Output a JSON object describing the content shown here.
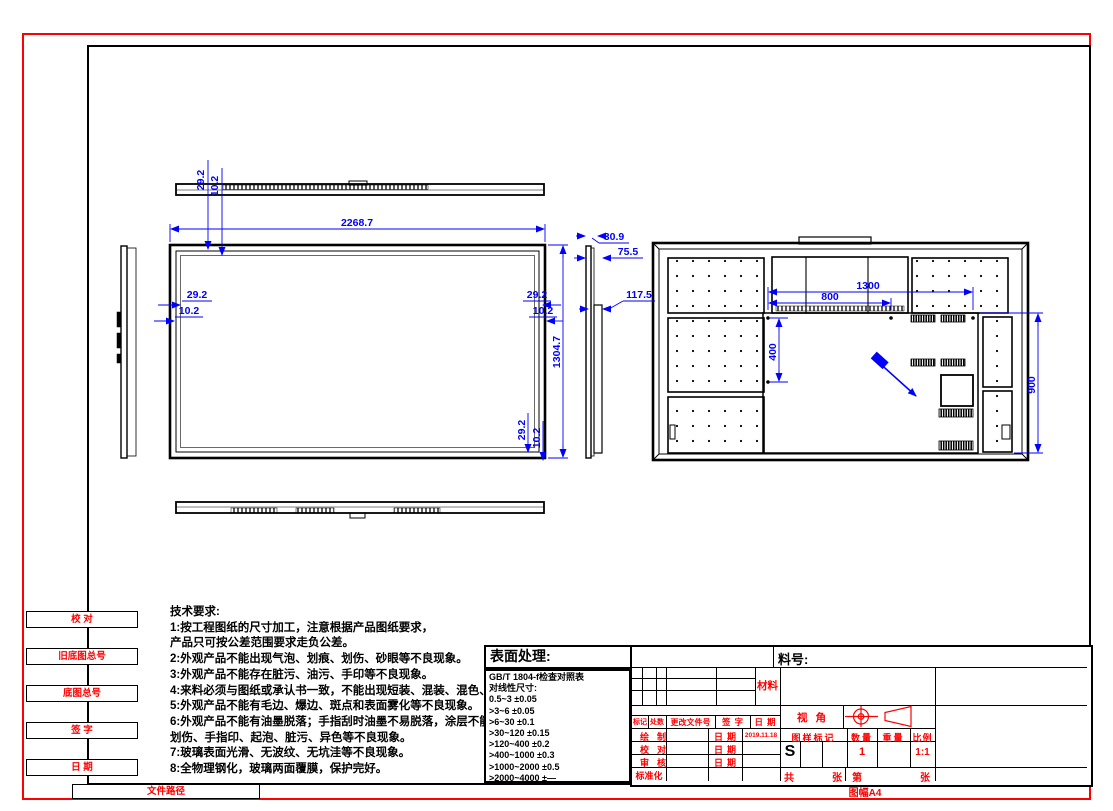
{
  "margin": {
    "labels": [
      "校  对",
      "旧底图总号",
      "底图总号",
      "签  字",
      "日  期",
      "文件路径"
    ]
  },
  "tech": {
    "title": "技术要求:",
    "lines": [
      "1:按工程图纸的尺寸加工，注意根据产品图纸要求，",
      "产品只可按公差范围要求走负公差。",
      "2:外观产品不能出现气泡、划痕、划伤、砂眼等不良现象。",
      "3:外观产品不能存在脏污、油污、手印等不良现象。",
      "4:来料必须与图纸或承认书一致，不能出现短装、混装、混色、异色等现象。",
      "5:外观产品不能有毛边、爆边、斑点和表面雾化等不良现象。",
      "6:外观产品不能有油墨脱落；手指刮时油墨不易脱落，涂层不能有划痕、",
      "划伤、手指印、起泡、脏污、异色等不良现象。",
      "7:玻璃表面光滑、无波纹、无坑洼等不良现象。",
      "8:全物理钢化，玻璃两面覆膜，保护完好。"
    ]
  },
  "surface": {
    "title": "表面处理:",
    "table": [
      "GB/T 1804-f检查对照表",
      "对线性尺寸:",
      "0.5~3  ±0.05",
      ">3~6  ±0.05",
      ">6~30  ±0.1",
      ">30~120  ±0.15",
      ">120~400  ±0.2",
      ">400~1000  ±0.3",
      ">1000~2000  ±0.5",
      ">2000~4000  ±—"
    ]
  },
  "title_block": {
    "part_no_label": "料号:",
    "material_label": "材料",
    "view_label": "视角",
    "rev_cols": [
      "标记",
      "处数",
      "更改文件号",
      "签字",
      "日期"
    ],
    "sign_rows": [
      {
        "label": "绘制",
        "date_label": "日期",
        "value": "2019.11.18"
      },
      {
        "label": "校对",
        "date_label": "日期",
        "value": ""
      },
      {
        "label": "审核",
        "date_label": "日期",
        "value": ""
      },
      {
        "label": "标准化",
        "date_label": "",
        "value": ""
      }
    ],
    "mark_cols": [
      "图样标记",
      "数量",
      "重量",
      "比例"
    ],
    "mark_values": {
      "stage": "S",
      "qty": "1",
      "weight": "",
      "scale": "1:1"
    },
    "sheets": {
      "total": "共",
      "unit1": "张",
      "page": "第",
      "unit2": "张"
    },
    "sheet_size": "图幅A4"
  },
  "dims": {
    "front": {
      "width": "2268.7",
      "height": "1304.7",
      "bezel": "29.2",
      "bezel_inner": "10.2"
    },
    "side": {
      "a": "30.9",
      "b": "75.5",
      "c": "117.5"
    },
    "rear": {
      "w": "1300",
      "w2": "800",
      "h": "400",
      "h2": "900"
    }
  },
  "colors": {
    "red": "#ff0000",
    "blue": "#0000ff",
    "black": "#000000"
  }
}
